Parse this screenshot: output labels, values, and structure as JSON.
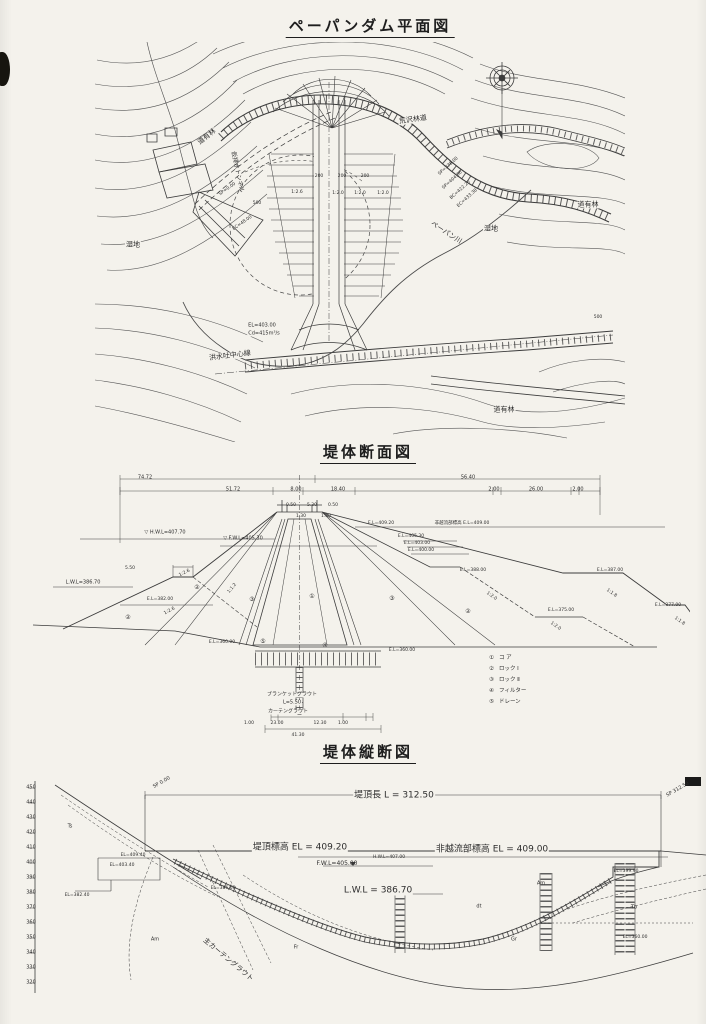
{
  "document": {
    "kind": "scanned engineering drawing",
    "language": "ja",
    "paper_color": "#f4f2ec",
    "ink_color": "#3a3a3a"
  },
  "sections": {
    "plan": {
      "title": "ペーパンダム平面図",
      "labels": [
        {
          "t": "道有林",
          "x": 207,
          "y": 137,
          "r": -38,
          "s": 7,
          "bg": 1,
          "n": "plan-label-forest"
        },
        {
          "t": "道有林",
          "x": 588,
          "y": 205,
          "s": 7,
          "bg": 1,
          "n": "plan-label-forest"
        },
        {
          "t": "道有林",
          "x": 504,
          "y": 410,
          "s": 7,
          "bg": 1,
          "n": "plan-label-forest"
        },
        {
          "t": "湿地",
          "x": 133,
          "y": 245,
          "s": 7,
          "bg": 1,
          "n": "plan-label-wetland"
        },
        {
          "t": "湿地",
          "x": 491,
          "y": 229,
          "s": 7,
          "bg": 1,
          "n": "plan-label-wetland"
        },
        {
          "t": "ペーパン川",
          "x": 446,
          "y": 233,
          "r": 33,
          "s": 7,
          "n": "plan-label-river"
        },
        {
          "t": "荒沢林道",
          "x": 413,
          "y": 120,
          "r": -8,
          "s": 7,
          "bg": 1,
          "n": "plan-label-forest-road"
        },
        {
          "t": "洪水吐中心線",
          "x": 230,
          "y": 356,
          "r": -7,
          "s": 7,
          "bg": 1,
          "n": "plan-label-spillway-centerline"
        },
        {
          "t": "EL=403.00",
          "x": 262,
          "y": 326,
          "s": 5,
          "bg": 1,
          "n": "plan-label-elevation"
        },
        {
          "t": "Cd=415m³/s",
          "x": 264,
          "y": 334,
          "s": 5,
          "bg": 1,
          "n": "plan-label-discharge"
        },
        {
          "t": "仮排水トンネル",
          "x": 237,
          "y": 172,
          "r": 78,
          "s": 6,
          "n": "plan-label-diversion-tunnel"
        },
        {
          "t": "SP=0.00",
          "x": 228,
          "y": 190,
          "r": -35,
          "s": 4.5
        },
        {
          "t": "EC=48.00",
          "x": 243,
          "y": 224,
          "r": -35,
          "s": 4.5
        },
        {
          "t": "500",
          "x": 257,
          "y": 204,
          "s": 4.5
        },
        {
          "t": "500",
          "x": 598,
          "y": 318,
          "s": 4.5
        },
        {
          "t": "SP=378.00",
          "x": 449,
          "y": 167,
          "r": -42,
          "s": 4.5
        },
        {
          "t": "SP=404.36",
          "x": 453,
          "y": 181,
          "r": -42,
          "s": 4.5
        },
        {
          "t": "BC=422.20",
          "x": 461,
          "y": 191,
          "r": -42,
          "s": 4.5
        },
        {
          "t": "EC=433.38",
          "x": 468,
          "y": 199,
          "r": -42,
          "s": 4.5
        },
        {
          "t": "200",
          "x": 319,
          "y": 177,
          "s": 4.5
        },
        {
          "t": "200",
          "x": 342,
          "y": 177,
          "s": 4.5
        },
        {
          "t": "200",
          "x": 365,
          "y": 177,
          "s": 4.5
        },
        {
          "t": "1:2.6",
          "x": 297,
          "y": 193,
          "s": 4.5
        },
        {
          "t": "1:2.0",
          "x": 338,
          "y": 194,
          "s": 4.5
        },
        {
          "t": "1:2.0",
          "x": 360,
          "y": 194,
          "s": 4.5
        },
        {
          "t": "1:2.0",
          "x": 383,
          "y": 194,
          "s": 4.5
        }
      ]
    },
    "cross_section": {
      "title": "堤体断面図",
      "legend": [
        {
          "num": "①",
          "label": "コ ア"
        },
        {
          "num": "②",
          "label": "ロック Ⅰ"
        },
        {
          "num": "③",
          "label": "ロック Ⅱ"
        },
        {
          "num": "④",
          "label": "フィルター"
        },
        {
          "num": "⑤",
          "label": "ドレーン"
        }
      ],
      "labels": [
        {
          "t": "74.72",
          "x": 145,
          "y": 478,
          "s": 5
        },
        {
          "t": "56.40",
          "x": 468,
          "y": 478,
          "s": 5
        },
        {
          "t": "51.72",
          "x": 233,
          "y": 490,
          "s": 5
        },
        {
          "t": "8.00",
          "x": 296,
          "y": 490,
          "s": 5
        },
        {
          "t": "18.40",
          "x": 338,
          "y": 490,
          "s": 5
        },
        {
          "t": "2.00",
          "x": 494,
          "y": 490,
          "s": 5
        },
        {
          "t": "26.00",
          "x": 536,
          "y": 490,
          "s": 5
        },
        {
          "t": "2.00",
          "x": 578,
          "y": 490,
          "s": 5
        },
        {
          "t": "0.50",
          "x": 291,
          "y": 506,
          "s": 4.5
        },
        {
          "t": "5.30",
          "x": 312,
          "y": 506,
          "s": 4.5
        },
        {
          "t": "0.50",
          "x": 333,
          "y": 506,
          "s": 4.5
        },
        {
          "t": "1.30",
          "x": 301,
          "y": 517,
          "s": 4.5
        },
        {
          "t": "1.30",
          "x": 326,
          "y": 517,
          "s": 4.5
        },
        {
          "t": "▽ H.W.L=407.70",
          "x": 165,
          "y": 533,
          "s": 5,
          "n": "cross-label-hwl"
        },
        {
          "t": "▽ F.W.L=405.30",
          "x": 243,
          "y": 539,
          "s": 5,
          "n": "cross-label-fwl"
        },
        {
          "t": "L.W.L=386.70",
          "x": 83,
          "y": 583,
          "s": 5,
          "n": "cross-label-lwl"
        },
        {
          "t": "5.50",
          "x": 130,
          "y": 569,
          "s": 4.5
        },
        {
          "t": "E.L=382.00",
          "x": 160,
          "y": 600,
          "s": 4.5
        },
        {
          "t": "E.L=409.20",
          "x": 381,
          "y": 524,
          "s": 4.5
        },
        {
          "t": "非越流部標高 E.L=409.00",
          "x": 462,
          "y": 524,
          "s": 4.5
        },
        {
          "t": "E.L=405.30",
          "x": 411,
          "y": 537,
          "s": 4.5
        },
        {
          "t": "E.L=403.00",
          "x": 417,
          "y": 544,
          "s": 4.5
        },
        {
          "t": "E.L=400.00",
          "x": 421,
          "y": 551,
          "s": 4.5
        },
        {
          "t": "E.L=388.00",
          "x": 473,
          "y": 571,
          "s": 4.5
        },
        {
          "t": "E.L=387.00",
          "x": 610,
          "y": 571,
          "s": 4.5
        },
        {
          "t": "E.L=375.00",
          "x": 561,
          "y": 611,
          "s": 4.5
        },
        {
          "t": "E.L=377.00",
          "x": 668,
          "y": 606,
          "s": 4.5
        },
        {
          "t": "E.L=360.00",
          "x": 222,
          "y": 643,
          "s": 4.5
        },
        {
          "t": "E.L=360.00",
          "x": 402,
          "y": 651,
          "s": 4.5
        },
        {
          "t": "1:2.6",
          "x": 185,
          "y": 574,
          "r": -27,
          "s": 4.5
        },
        {
          "t": "1:1.2",
          "x": 233,
          "y": 589,
          "r": -50,
          "s": 4.5
        },
        {
          "t": "1:2.6",
          "x": 170,
          "y": 612,
          "r": -28,
          "s": 4.5
        },
        {
          "t": "1:2.0",
          "x": 491,
          "y": 597,
          "r": 35,
          "s": 4.5
        },
        {
          "t": "1:1.8",
          "x": 611,
          "y": 594,
          "r": 35,
          "s": 4.5
        },
        {
          "t": "1:2.0",
          "x": 555,
          "y": 627,
          "r": 35,
          "s": 4.5
        },
        {
          "t": "1:1.8",
          "x": 679,
          "y": 622,
          "r": 35,
          "s": 4.5
        },
        {
          "t": "②",
          "x": 197,
          "y": 588,
          "s": 6
        },
        {
          "t": "③",
          "x": 252,
          "y": 600,
          "s": 6
        },
        {
          "t": "①",
          "x": 312,
          "y": 597,
          "s": 6
        },
        {
          "t": "③",
          "x": 392,
          "y": 599,
          "s": 6
        },
        {
          "t": "②",
          "x": 468,
          "y": 612,
          "s": 6
        },
        {
          "t": "②",
          "x": 128,
          "y": 618,
          "s": 6
        },
        {
          "t": "④",
          "x": 325,
          "y": 646,
          "s": 6
        },
        {
          "t": "⑤",
          "x": 263,
          "y": 642,
          "s": 6
        },
        {
          "t": "ブランケットグラウト",
          "x": 292,
          "y": 695,
          "s": 5,
          "bg": 1,
          "n": "cross-label-blanket-grout"
        },
        {
          "t": "L=5.50",
          "x": 292,
          "y": 703,
          "s": 5,
          "bg": 1
        },
        {
          "t": "カーテングラウト",
          "x": 288,
          "y": 712,
          "s": 5,
          "bg": 1,
          "n": "cross-label-curtain-grout"
        },
        {
          "t": "1.00",
          "x": 249,
          "y": 724,
          "s": 4.5
        },
        {
          "t": "23.00",
          "x": 277,
          "y": 724,
          "s": 4.5
        },
        {
          "t": "12.30",
          "x": 320,
          "y": 724,
          "s": 4.5
        },
        {
          "t": "1.00",
          "x": 343,
          "y": 724,
          "s": 4.5
        },
        {
          "t": "41.30",
          "x": 298,
          "y": 736,
          "s": 4.5
        }
      ]
    },
    "longitudinal": {
      "title": "堤体縦断図",
      "elevation_scale": {
        "values": [
          450,
          440,
          430,
          420,
          410,
          400,
          390,
          380,
          370,
          360,
          350,
          340,
          330,
          320
        ]
      },
      "labels": [
        {
          "t": "SP 0.00",
          "x": 162,
          "y": 783,
          "r": -30,
          "s": 5
        },
        {
          "t": "SP 312.50",
          "x": 678,
          "y": 790,
          "r": -30,
          "s": 5
        },
        {
          "t": "堤頂長  L = 312.50",
          "x": 394,
          "y": 796,
          "s": 9,
          "bg": 1,
          "n": "longi-label-crest-length"
        },
        {
          "t": "堤頂標高 EL = 409.20",
          "x": 300,
          "y": 848,
          "s": 9,
          "bg": 1,
          "n": "longi-label-crest-elevation"
        },
        {
          "t": "H.W.L=407.00",
          "x": 389,
          "y": 858,
          "s": 4.5,
          "n": "longi-label-hwl"
        },
        {
          "t": "非越流部標高 EL = 409.00",
          "x": 492,
          "y": 850,
          "s": 9,
          "bg": 1,
          "n": "longi-label-nonoverflow-elevation"
        },
        {
          "t": "F.W.L=405.00",
          "x": 337,
          "y": 864,
          "s": 6,
          "n": "longi-label-fwl"
        },
        {
          "t": "L.W.L = 386.70",
          "x": 378,
          "y": 891,
          "s": 9,
          "bg": 1,
          "n": "longi-label-lwl"
        },
        {
          "t": "EL=409.40",
          "x": 133,
          "y": 856,
          "s": 4.5
        },
        {
          "t": "EL=403.40",
          "x": 122,
          "y": 866,
          "s": 4.5
        },
        {
          "t": "EL=382.40",
          "x": 77,
          "y": 896,
          "s": 4.5
        },
        {
          "t": "EL=386.60",
          "x": 223,
          "y": 889,
          "s": 4.5
        },
        {
          "t": "EL=399.90",
          "x": 626,
          "y": 872,
          "s": 4.5
        },
        {
          "t": "EL=360.00",
          "x": 635,
          "y": 938,
          "s": 4.5
        },
        {
          "t": "主カーテングラウト",
          "x": 228,
          "y": 960,
          "r": 40,
          "s": 7,
          "n": "longi-label-main-curtain-grout"
        },
        {
          "t": "Ts",
          "x": 70,
          "y": 827,
          "s": 5,
          "n": "longi-label-geology"
        },
        {
          "t": "Am",
          "x": 155,
          "y": 940,
          "s": 5,
          "n": "longi-label-geology"
        },
        {
          "t": "Am",
          "x": 541,
          "y": 884,
          "s": 5,
          "n": "longi-label-geology"
        },
        {
          "t": "dt",
          "x": 479,
          "y": 907,
          "s": 5,
          "n": "longi-label-geology"
        },
        {
          "t": "Tb",
          "x": 634,
          "y": 908,
          "s": 5,
          "n": "longi-label-geology"
        },
        {
          "t": "Gr",
          "x": 514,
          "y": 940,
          "s": 5,
          "n": "longi-label-geology"
        },
        {
          "t": "Fr",
          "x": 296,
          "y": 948,
          "s": 5,
          "n": "longi-label-geology"
        }
      ]
    }
  }
}
